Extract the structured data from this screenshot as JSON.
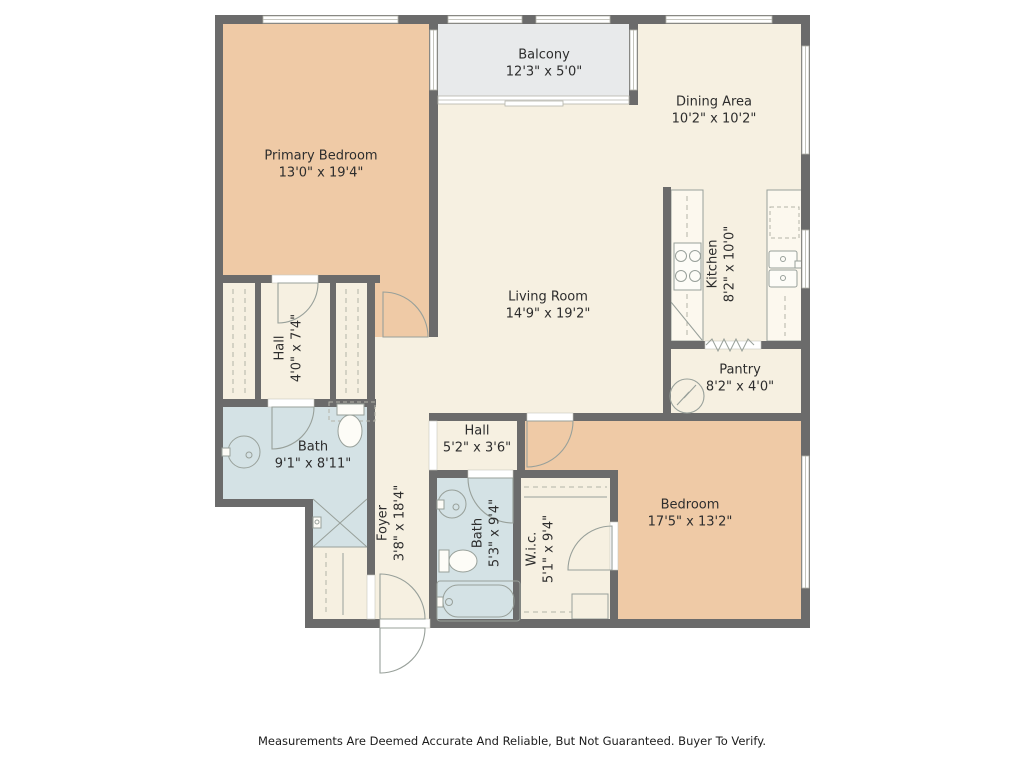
{
  "plan": {
    "rooms": [
      {
        "id": "balcony",
        "name": "Balcony",
        "dims": "12'3\" x 5'0\""
      },
      {
        "id": "dining-area",
        "name": "Dining Area",
        "dims": "10'2\" x 10'2\""
      },
      {
        "id": "primary-bedroom",
        "name": "Primary Bedroom",
        "dims": "13'0\" x 19'4\""
      },
      {
        "id": "living-room",
        "name": "Living Room",
        "dims": "14'9\" x 19'2\""
      },
      {
        "id": "kitchen",
        "name": "Kitchen",
        "dims": "8'2\" x 10'0\""
      },
      {
        "id": "hall-upper",
        "name": "Hall",
        "dims": "4'0\" x 7'4\""
      },
      {
        "id": "pantry",
        "name": "Pantry",
        "dims": "8'2\" x 4'0\""
      },
      {
        "id": "bath-main",
        "name": "Bath",
        "dims": "9'1\" x 8'11\""
      },
      {
        "id": "hall-lower",
        "name": "Hall",
        "dims": "5'2\" x 3'6\""
      },
      {
        "id": "foyer",
        "name": "Foyer",
        "dims": "3'8\" x 18'4\""
      },
      {
        "id": "bath-second",
        "name": "Bath",
        "dims": "5'3\" x 9'4\""
      },
      {
        "id": "wic",
        "name": "W.i.c.",
        "dims": "5'1\" x 9'4\""
      },
      {
        "id": "bedroom",
        "name": "Bedroom",
        "dims": "17'5\" x 13'2\""
      }
    ],
    "fixtures": [
      "stove-icon",
      "kitchen-sink-icon",
      "dishwasher-icon",
      "pedestal-sink-icon",
      "toilet-icon",
      "shower-icon",
      "bathtub-icon",
      "bifold-door-icon",
      "door-arc-icon",
      "window-icon"
    ],
    "disclaimer": "Measurements Are Deemed Accurate And Reliable, But Not Guaranteed. Buyer To Verify."
  },
  "colors": {
    "wall": "#6b6b6b",
    "floor": "#f6f0e1",
    "bedroom": "#efcaa6",
    "bath": "#d4e2e5",
    "balcony": "#e8eaeb",
    "fixture": "#98a09a",
    "label": "#2d2d2d"
  }
}
